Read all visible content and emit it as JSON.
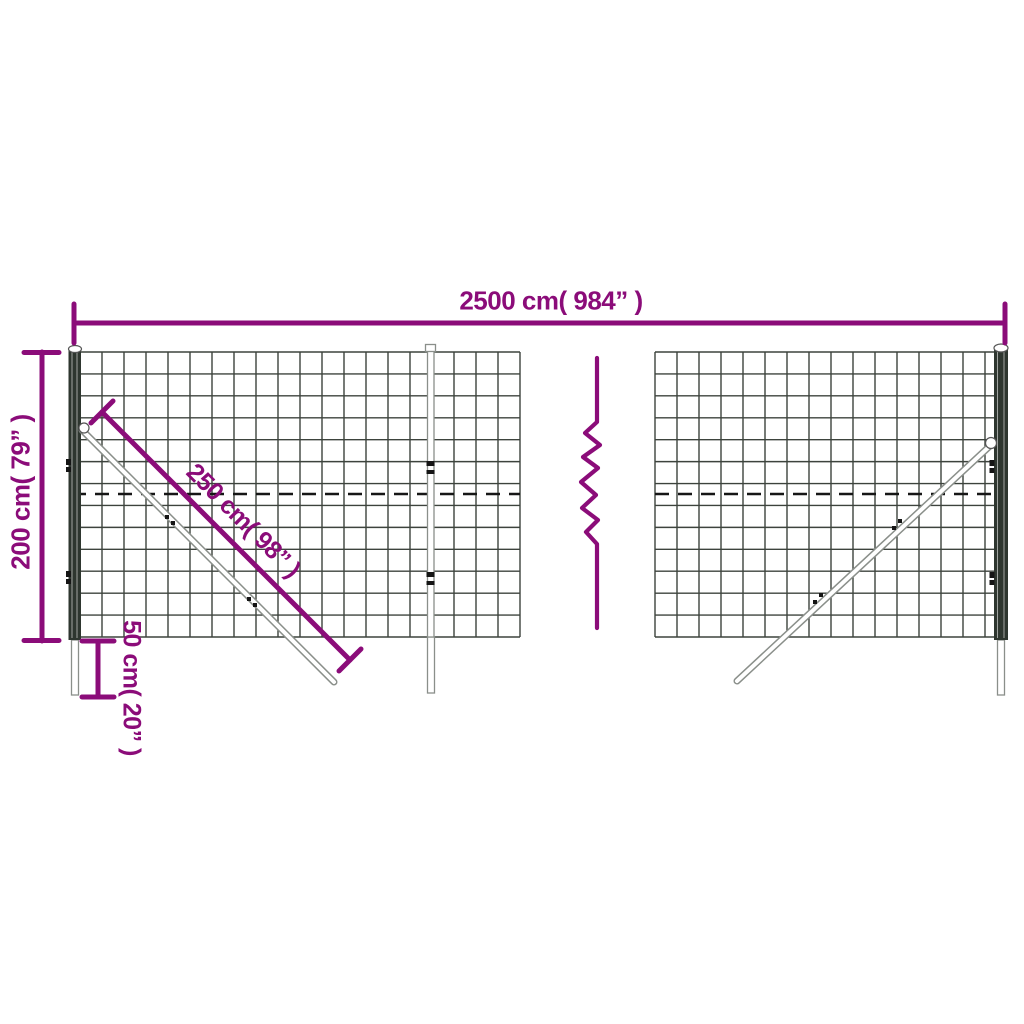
{
  "page": {
    "background": "#ffffff"
  },
  "colors": {
    "dimension": "#8b0c79",
    "mesh": "#3d433d",
    "post": "#2e362f",
    "outline": "#8a8f8a",
    "dashed_wire": "#161616"
  },
  "labels": {
    "total_width": "2500 cm( 984” )",
    "total_height": "200 cm( 79” )",
    "brace_length": "250 cm( 98” )",
    "ground_depth": "50 cm( 20” )"
  },
  "mesh": {
    "cell_px": 22,
    "row_count": 13,
    "panels": [
      {
        "x1": 80,
        "x2": 520,
        "y1": 352,
        "y2": 637
      },
      {
        "x1": 655,
        "x2": 1007,
        "y1": 352,
        "y2": 637
      }
    ]
  }
}
